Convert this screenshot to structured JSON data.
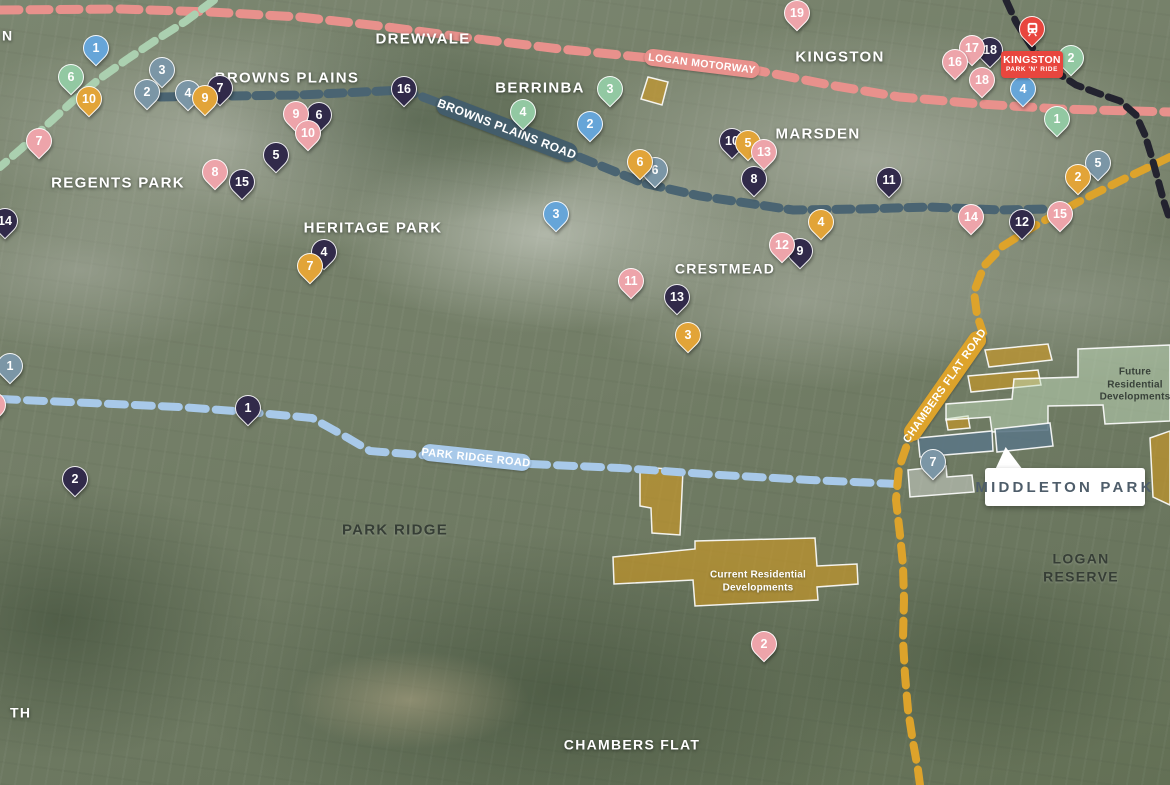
{
  "canvas": {
    "width": 1170,
    "height": 785
  },
  "callout": {
    "text": "MIDDLETON PARK"
  },
  "station": {
    "name": "KINGSTON",
    "sub": "PARK 'N' RIDE",
    "color": "#e8463e",
    "icon": "train-icon"
  },
  "pin_colors": {
    "blue": "#66a5d8",
    "green": "#92c8a2",
    "steel": "#7b96a6",
    "orange": "#e2a438",
    "navy": "#312a4a",
    "pink": "#eda4aa",
    "red": "#e8463e"
  },
  "zone_styles": {
    "gold": {
      "fill": "#cf9a22",
      "opacity": 0.62
    },
    "green": {
      "fill": "#c3ddbd",
      "opacity": 0.5
    },
    "slate": {
      "fill": "#5b7584",
      "opacity": 0.9
    },
    "lightgray": {
      "fill": "#d8dcd6",
      "opacity": 0.5
    }
  },
  "labels": [
    {
      "text": "N",
      "x": 2,
      "y": 36,
      "style": "light",
      "fs": 14,
      "anchor": "left"
    },
    {
      "text": "DREWVALE",
      "x": 423,
      "y": 40,
      "style": "light",
      "fs": 15
    },
    {
      "text": "BROWNS PLAINS",
      "x": 287,
      "y": 79,
      "style": "light",
      "fs": 15
    },
    {
      "text": "BERRINBA",
      "x": 540,
      "y": 89,
      "style": "light",
      "fs": 15
    },
    {
      "text": "KINGSTON",
      "x": 840,
      "y": 58,
      "style": "light",
      "fs": 15
    },
    {
      "text": "MARSDEN",
      "x": 818,
      "y": 135,
      "style": "light",
      "fs": 15
    },
    {
      "text": "REGENTS PARK",
      "x": 118,
      "y": 184,
      "style": "light",
      "fs": 15
    },
    {
      "text": "HERITAGE PARK",
      "x": 373,
      "y": 229,
      "style": "light",
      "fs": 15
    },
    {
      "text": "CRESTMEAD",
      "x": 725,
      "y": 269,
      "style": "light",
      "fs": 14
    },
    {
      "text": "PARK RIDGE",
      "x": 395,
      "y": 531,
      "style": "dark",
      "fs": 15
    },
    {
      "text": "LOGAN RESERVE",
      "x": 1081,
      "y": 568,
      "style": "dark",
      "fs": 14
    },
    {
      "text": "CHAMBERS FLAT",
      "x": 632,
      "y": 745,
      "style": "light",
      "fs": 14
    },
    {
      "text": "TH",
      "x": 10,
      "y": 713,
      "style": "light",
      "fs": 14,
      "anchor": "left"
    },
    {
      "text": "Future Residential\nDevelopments",
      "x": 1135,
      "y": 385,
      "style": "dark-small",
      "fs": 10
    },
    {
      "text": "Current Residential\nDevelopments",
      "x": 758,
      "y": 582,
      "style": "light-small",
      "fs": 10
    }
  ],
  "roads": [
    {
      "id": "logan-motorway",
      "label": "LOGAN MOTORWAY",
      "color": "#e8918c",
      "width": 9,
      "dash": "19 11",
      "points": "0,10 120,9 210,12 300,17 380,26 470,38 560,49 640,57 700,64 760,71 830,85 900,97 980,104 1060,109 1170,112",
      "ribbon": {
        "x": 702,
        "y": 63,
        "w": 116,
        "h": 17,
        "rot": 7,
        "bg": "#e8918c",
        "fs": 10.5
      }
    },
    {
      "id": "green-route",
      "label": "",
      "color": "#abd0b0",
      "width": 8,
      "dash": "15 9",
      "points": "214,0 186,21 156,40 126,60 98,80 74,100 48,124 22,148 0,167"
    },
    {
      "id": "browns-plains-road",
      "label": "BROWNS PLAINS ROAD",
      "color": "#4a6472",
      "width": 9,
      "dash": "15 9",
      "points": "160,97 300,95 404,90 447,106 567,152 643,183 700,196 793,210 860,209 930,207 1000,210 1048,209",
      "ribbon": {
        "x": 507,
        "y": 129,
        "w": 150,
        "h": 20,
        "rot": 21,
        "bg": "#435d6b",
        "fs": 12
      }
    },
    {
      "id": "park-ridge-road",
      "label": "PARK RIDGE ROAD",
      "color": "#a8c9e9",
      "width": 8,
      "dash": "17 10",
      "points": "0,399 90,403 180,407 248,412 312,418 348,438 370,451 420,455 470,459 530,464 620,468 720,475 810,480 898,484",
      "ribbon": {
        "x": 476,
        "y": 457,
        "w": 110,
        "h": 17,
        "rot": 6,
        "bg": "#a8c9e9",
        "fs": 11
      }
    },
    {
      "id": "chambers-flat-road",
      "label": "CHAMBERS FLAT ROAD",
      "color": "#dda32b",
      "width": 8,
      "dash": "15 10",
      "points": "1170,157 1128,177 1082,200 1038,224 1003,246 984,266 974,292 977,315 983,333 958,372 932,408 908,442 899,468 896,500 900,535 903,565 904,600 903,640 905,675 908,710 913,742 918,770 920,785",
      "ribbon": {
        "x": 945,
        "y": 386,
        "w": 130,
        "h": 18,
        "rot": -55,
        "bg": "#dda32b",
        "fs": 11
      }
    },
    {
      "id": "railway-line",
      "label": "",
      "color": "#23232f",
      "width": 7,
      "dash": "13 8",
      "points": "1006,0 1016,22 1031,46 1050,68 1076,85 1100,94 1120,101 1136,115 1145,135 1152,158 1158,180 1164,202 1170,220"
    }
  ],
  "zones": [
    {
      "id": "berrinba-parcel",
      "type": "gold",
      "points": "648,77 668,82 662,105 641,99"
    },
    {
      "id": "future-parcel-a",
      "type": "gold",
      "points": "985,350 1048,344 1052,360 989,367"
    },
    {
      "id": "future-parcel-b",
      "type": "gold",
      "points": "968,376 1038,370 1041,385 971,392"
    },
    {
      "id": "future-parcel-c",
      "type": "gold",
      "points": "946,419 968,416 970,428 948,430"
    },
    {
      "id": "east-parcel",
      "type": "gold",
      "points": "1150,438 1170,431 1170,505 1153,497"
    },
    {
      "id": "current-parcel-a",
      "type": "gold",
      "points": "640,467 683,470 680,535 652,533 651,508 640,506"
    },
    {
      "id": "current-developments",
      "type": "gold",
      "points": "613,557 695,549 695,541 815,538 817,566 857,564 858,584 817,587 818,600 695,606 693,580 614,584"
    },
    {
      "id": "future-developments",
      "type": "green",
      "points": "1078,349 1170,345 1170,421 1105,424 1103,405 1048,406 1048,430 992,432 990,417 946,420 946,404 1012,399 1014,379 1078,377"
    },
    {
      "id": "middleton-site-a",
      "type": "slate",
      "points": "918,438 992,431 993,451 920,457"
    },
    {
      "id": "middleton-site-b",
      "type": "slate",
      "points": "995,429 1050,423 1053,446 997,452"
    },
    {
      "id": "middleton-site-c",
      "type": "lightgray",
      "points": "908,470 946,466 947,477 972,475 974,492 910,497"
    }
  ],
  "pins": [
    {
      "n": "3",
      "c": "steel",
      "x": 162,
      "y": 70
    },
    {
      "n": "2",
      "c": "steel",
      "x": 147,
      "y": 92
    },
    {
      "n": "4",
      "c": "steel",
      "x": 188,
      "y": 93
    },
    {
      "n": "6",
      "c": "steel",
      "x": 655,
      "y": 170
    },
    {
      "n": "5",
      "c": "steel",
      "x": 1098,
      "y": 163
    },
    {
      "n": "1",
      "c": "steel",
      "x": 10,
      "y": 366
    },
    {
      "n": "7",
      "c": "steel",
      "x": 933,
      "y": 462
    },
    {
      "n": "6",
      "c": "green",
      "x": 71,
      "y": 77
    },
    {
      "n": "4",
      "c": "green",
      "x": 523,
      "y": 112
    },
    {
      "n": "3",
      "c": "green",
      "x": 610,
      "y": 89
    },
    {
      "n": "2",
      "c": "green",
      "x": 1071,
      "y": 58
    },
    {
      "n": "1",
      "c": "green",
      "x": 1057,
      "y": 119
    },
    {
      "n": "1",
      "c": "blue",
      "x": 96,
      "y": 48
    },
    {
      "n": "2",
      "c": "blue",
      "x": 590,
      "y": 124
    },
    {
      "n": "3",
      "c": "blue",
      "x": 556,
      "y": 214
    },
    {
      "n": "4",
      "c": "blue",
      "x": 1023,
      "y": 89
    },
    {
      "n": "7",
      "c": "navy",
      "x": 220,
      "y": 88
    },
    {
      "n": "16",
      "c": "navy",
      "x": 404,
      "y": 89
    },
    {
      "n": "6",
      "c": "navy",
      "x": 319,
      "y": 115
    },
    {
      "n": "5",
      "c": "navy",
      "x": 276,
      "y": 155
    },
    {
      "n": "15",
      "c": "navy",
      "x": 242,
      "y": 182
    },
    {
      "n": "14",
      "c": "navy",
      "x": 5,
      "y": 221
    },
    {
      "n": "4",
      "c": "navy",
      "x": 324,
      "y": 252
    },
    {
      "n": "10",
      "c": "navy",
      "x": 732,
      "y": 141
    },
    {
      "n": "8",
      "c": "navy",
      "x": 754,
      "y": 179
    },
    {
      "n": "11",
      "c": "navy",
      "x": 889,
      "y": 180
    },
    {
      "n": "9",
      "c": "navy",
      "x": 800,
      "y": 251
    },
    {
      "n": "13",
      "c": "navy",
      "x": 677,
      "y": 297
    },
    {
      "n": "12",
      "c": "navy",
      "x": 1022,
      "y": 222
    },
    {
      "n": "1",
      "c": "navy",
      "x": 248,
      "y": 408
    },
    {
      "n": "2",
      "c": "navy",
      "x": 75,
      "y": 479
    },
    {
      "n": "18",
      "c": "navy",
      "x": 990,
      "y": 50
    },
    {
      "n": "10",
      "c": "orange",
      "x": 89,
      "y": 99
    },
    {
      "n": "9",
      "c": "orange",
      "x": 205,
      "y": 98
    },
    {
      "n": "7",
      "c": "orange",
      "x": 310,
      "y": 266
    },
    {
      "n": "6",
      "c": "orange",
      "x": 640,
      "y": 162
    },
    {
      "n": "5",
      "c": "orange",
      "x": 748,
      "y": 143
    },
    {
      "n": "4",
      "c": "orange",
      "x": 821,
      "y": 222
    },
    {
      "n": "3",
      "c": "orange",
      "x": 688,
      "y": 335
    },
    {
      "n": "2",
      "c": "orange",
      "x": 1078,
      "y": 177
    },
    {
      "n": "7",
      "c": "pink",
      "x": 39,
      "y": 141
    },
    {
      "n": "9",
      "c": "pink",
      "x": 296,
      "y": 114
    },
    {
      "n": "10",
      "c": "pink",
      "x": 308,
      "y": 133
    },
    {
      "n": "8",
      "c": "pink",
      "x": 215,
      "y": 172
    },
    {
      "n": "19",
      "c": "pink",
      "x": 797,
      "y": 13
    },
    {
      "n": "17",
      "c": "pink",
      "x": 972,
      "y": 48
    },
    {
      "n": "16",
      "c": "pink",
      "x": 955,
      "y": 62
    },
    {
      "n": "18",
      "c": "pink",
      "x": 982,
      "y": 80
    },
    {
      "n": "13",
      "c": "pink",
      "x": 764,
      "y": 152
    },
    {
      "n": "12",
      "c": "pink",
      "x": 782,
      "y": 245
    },
    {
      "n": "11",
      "c": "pink",
      "x": 631,
      "y": 281
    },
    {
      "n": "14",
      "c": "pink",
      "x": 971,
      "y": 217
    },
    {
      "n": "15",
      "c": "pink",
      "x": 1060,
      "y": 214
    },
    {
      "n": "2",
      "c": "pink",
      "x": 764,
      "y": 644
    },
    {
      "n": "",
      "c": "pink",
      "x": -7,
      "y": 405
    },
    {
      "n": "",
      "c": "red",
      "x": 1032,
      "y": 29,
      "train": true
    }
  ]
}
